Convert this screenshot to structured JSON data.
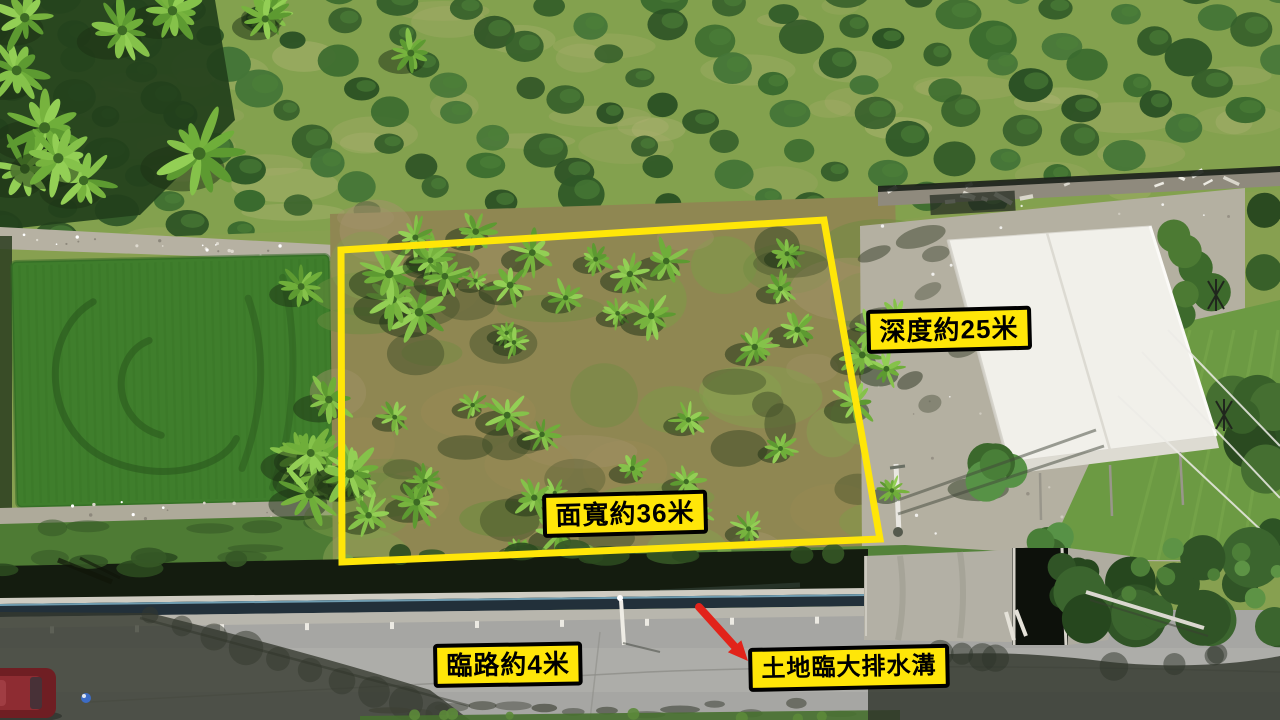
{
  "annotations": {
    "depth": {
      "label": "深度約25米"
    },
    "frontage": {
      "label": "面寬約36米"
    },
    "road": {
      "label": "臨路約4米"
    },
    "drainage": {
      "label": "土地臨大排水溝"
    }
  },
  "colors": {
    "annotation_yellow": "#ffe608",
    "annotation_border": "#000000",
    "arrow_red": "#e2231a"
  }
}
